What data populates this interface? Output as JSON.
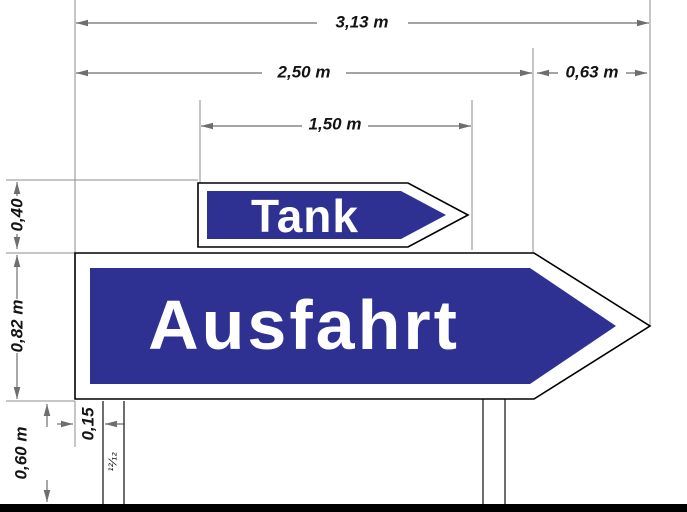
{
  "dimensions": {
    "total_width": "3,13 m",
    "body_width": "2,50 m",
    "arrowhead_width": "0,63 m",
    "tank_width": "1,50 m",
    "tank_height": "0,40",
    "ausfahrt_height": "0,82 m",
    "ground_clearance": "0,60 m",
    "post_offset": "0,15",
    "post_section": "¹²⁄₁₂"
  },
  "signs": {
    "tank": "Tank",
    "ausfahrt": "Ausfahrt"
  },
  "colors": {
    "sign_blue": "#2e3192",
    "sign_white": "#ffffff",
    "outline_black": "#000000",
    "dimension_gray": "#6e6e6e",
    "extension_gray": "#8c8c8c",
    "ground_black": "#000000",
    "background": "#ffffff"
  }
}
